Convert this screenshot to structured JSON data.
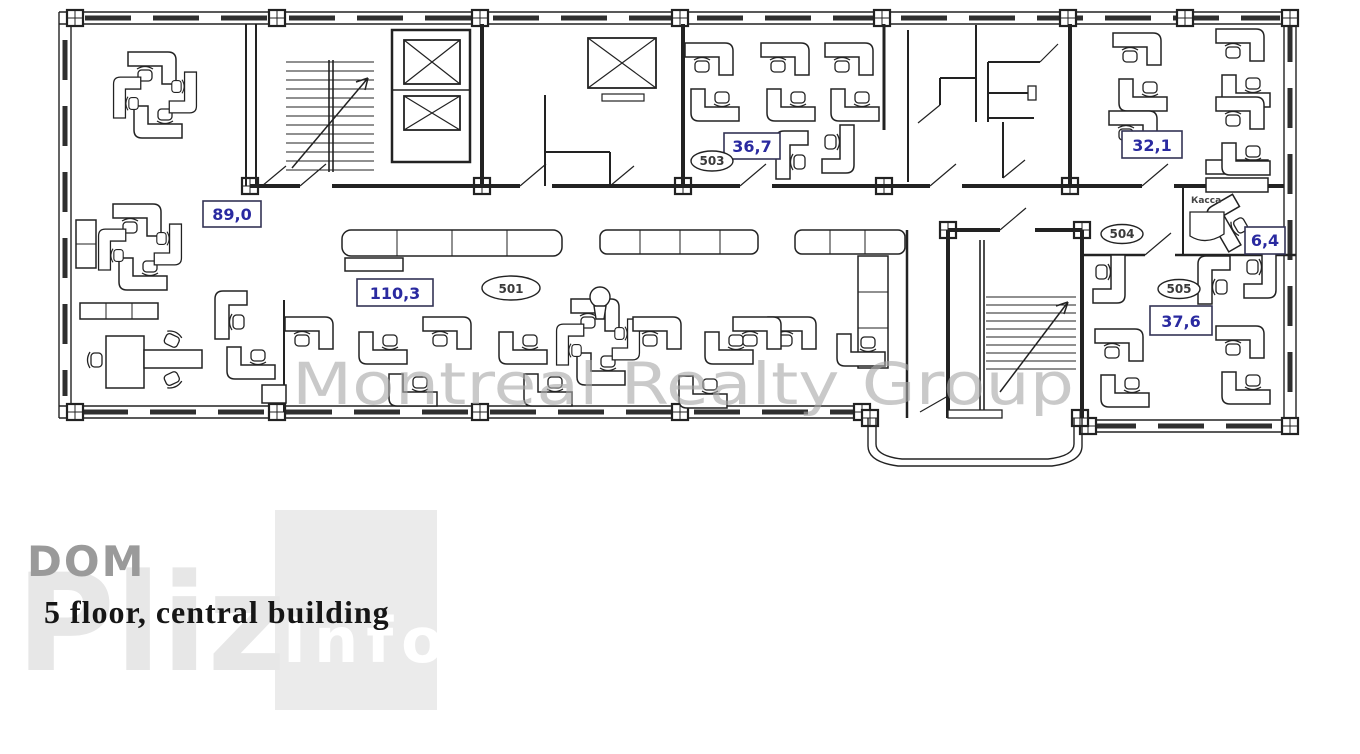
{
  "page": {
    "background": "#ffffff"
  },
  "caption": {
    "text": "5 floor, central building"
  },
  "watermarks": {
    "realty_group": "Montreal Realty Group",
    "dom": "DOM",
    "pliz": "Pliz",
    "info": "Info"
  },
  "floor_plan": {
    "colors": {
      "accent_blue": "#2a2aa0",
      "wall_line": "#222222",
      "watermark_gray": "#a9a9a9",
      "watermark_pale": "#e7e7e7",
      "watermark_square": "#ebebeb",
      "dom_gray": "#9a9a9a"
    },
    "area_labels": [
      {
        "id": "area-89-0",
        "text": "89,0"
      },
      {
        "id": "area-110-3",
        "text": "110,3"
      },
      {
        "id": "area-36-7",
        "text": "36,7"
      },
      {
        "id": "area-32-1",
        "text": "32,1"
      },
      {
        "id": "area-6-4",
        "text": "6,4"
      },
      {
        "id": "area-37-6",
        "text": "37,6"
      }
    ],
    "room_numbers": [
      {
        "id": "room-503",
        "text": "503"
      },
      {
        "id": "room-501",
        "text": "501"
      },
      {
        "id": "room-504",
        "text": "504"
      },
      {
        "id": "room-505",
        "text": "505"
      }
    ],
    "annotations": [
      {
        "id": "kassa",
        "text": "Касса"
      }
    ]
  }
}
